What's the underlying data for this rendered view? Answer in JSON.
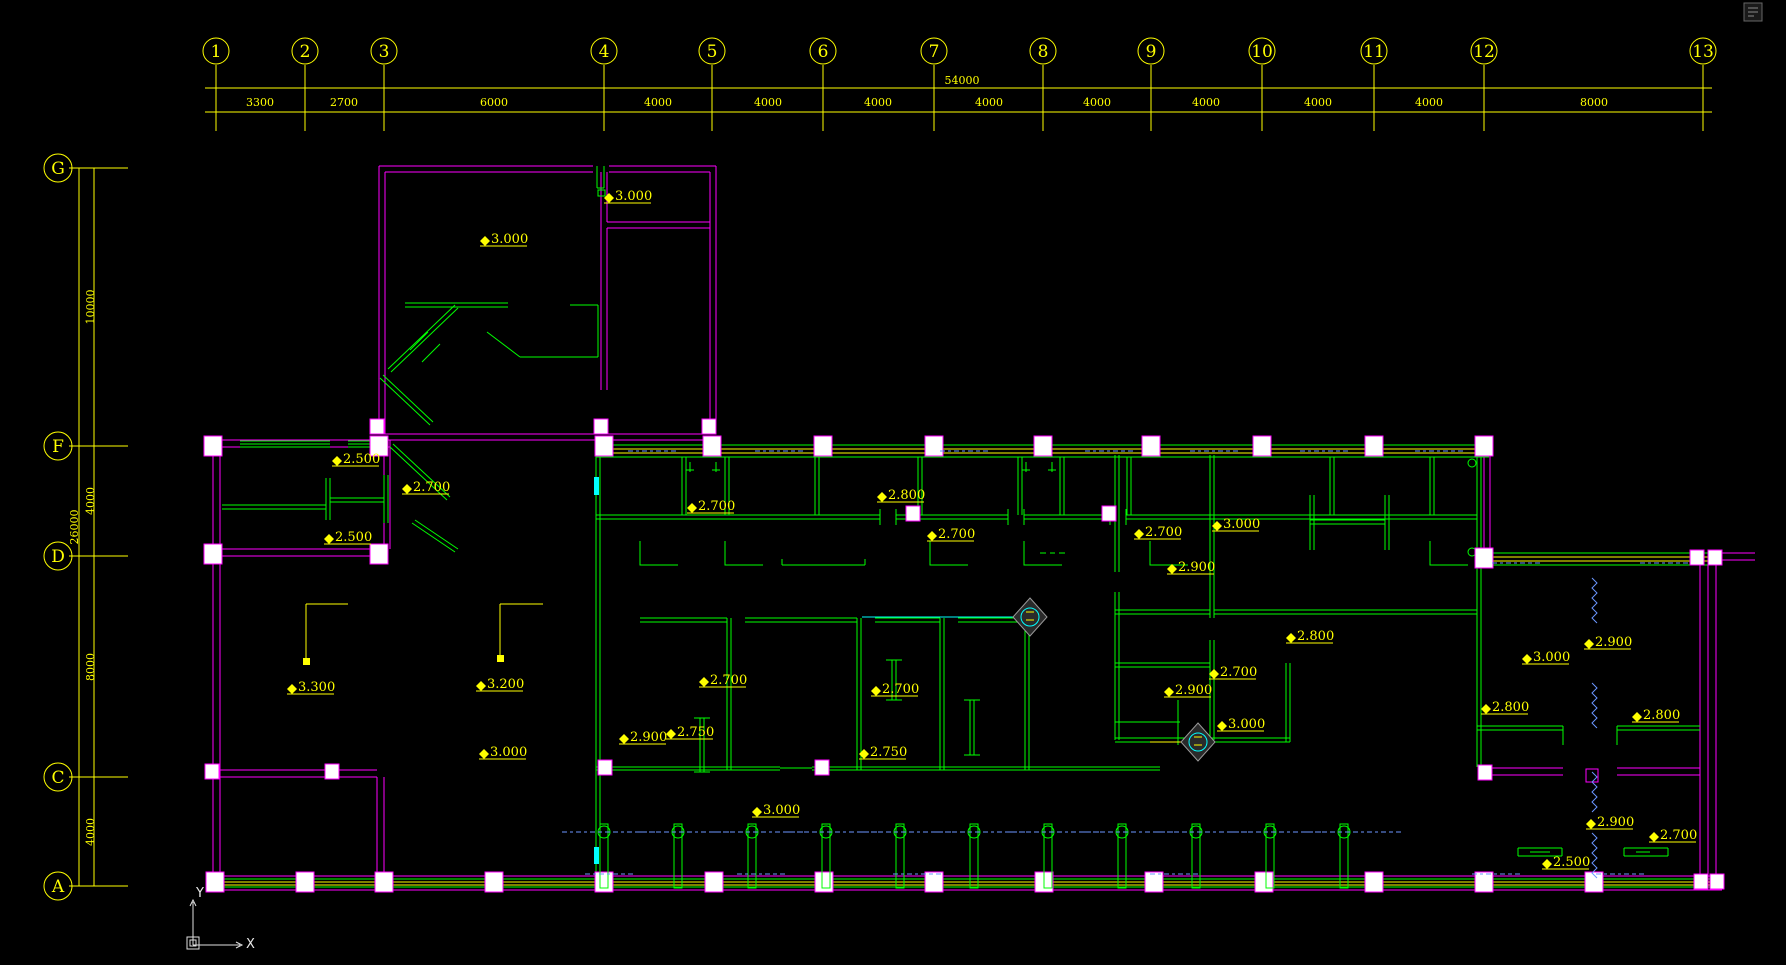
{
  "grid": {
    "cols": [
      {
        "label": "1"
      },
      {
        "label": "2"
      },
      {
        "label": "3"
      },
      {
        "label": "4"
      },
      {
        "label": "5"
      },
      {
        "label": "6"
      },
      {
        "label": "7"
      },
      {
        "label": "8"
      },
      {
        "label": "9"
      },
      {
        "label": "10"
      },
      {
        "label": "11"
      },
      {
        "label": "12"
      },
      {
        "label": "13"
      }
    ],
    "col_dims": [
      "3300",
      "2700",
      "6000",
      "4000",
      "4000",
      "4000",
      "4000",
      "4000",
      "4000",
      "4000",
      "4000",
      "8000"
    ],
    "total_width": "54000",
    "rows": [
      {
        "label": "G"
      },
      {
        "label": "F"
      },
      {
        "label": "D"
      },
      {
        "label": "C"
      },
      {
        "label": "A"
      }
    ],
    "row_dims": [
      "10000",
      "4000",
      "8000",
      "4000"
    ],
    "total_height": "26000"
  },
  "ucs": {
    "x": "X",
    "y": "Y"
  },
  "elevations": [
    "3.000",
    "3.000",
    "2.500",
    "2.700",
    "2.500",
    "2.700",
    "2.800",
    "2.700",
    "2.700",
    "3.000",
    "2.900",
    "2.800",
    "2.700",
    "2.900",
    "3.000",
    "2.900",
    "3.000",
    "2.800",
    "2.800",
    "3.300",
    "3.200",
    "3.000",
    "2.700",
    "2.700",
    "2.900",
    "2.750",
    "2.750",
    "3.000",
    "2.900",
    "2.700",
    "2.500"
  ],
  "colors": {
    "wall": "#FF00FF",
    "partition": "#00FF00",
    "annotation": "#FFFF00",
    "detail": "#00FFFF",
    "minor_text": "#6B96FF",
    "background": "#000000"
  }
}
